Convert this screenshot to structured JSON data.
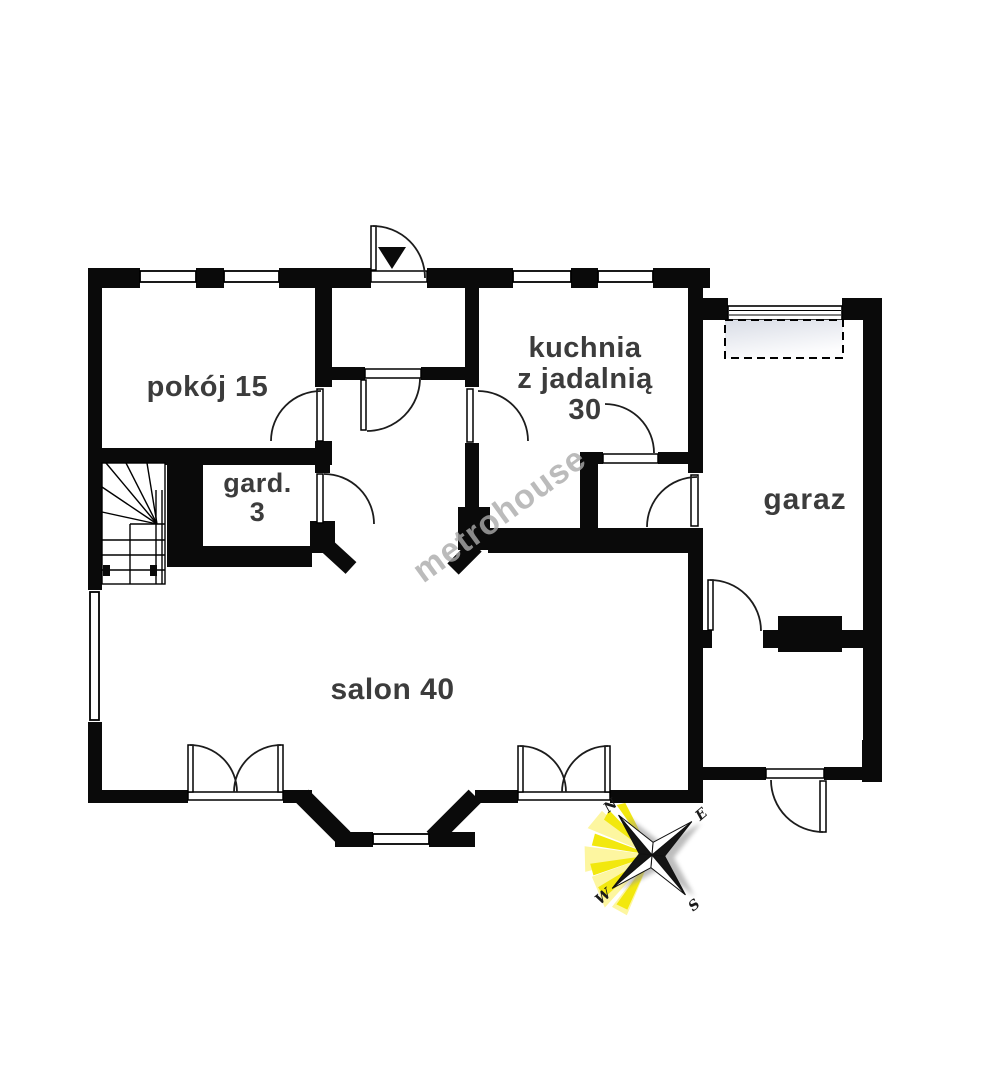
{
  "watermark": "metrohouse",
  "rooms": {
    "pokoj": {
      "name": "pokój",
      "area": 15,
      "label": "pokój 15"
    },
    "kuchnia": {
      "name": "kuchnia z jadalnią",
      "area": 30,
      "label": "kuchnia\nz jadalnią\n30"
    },
    "gard": {
      "name": "gard.",
      "area": 3,
      "label": "gard.\n3"
    },
    "garaz": {
      "name": "garaz",
      "label": "garaz"
    },
    "salon": {
      "name": "salon",
      "area": 40,
      "label": "salon 40"
    }
  },
  "compass": {
    "north": "N",
    "east": "E",
    "south": "S",
    "west": "W"
  },
  "colors": {
    "wall": "#0a0a0a",
    "label_text": "#3c3c3c",
    "watermark": "#ababab",
    "compass_ray": "#f2e80e",
    "garage_swing_fill": "#dde1e9"
  }
}
